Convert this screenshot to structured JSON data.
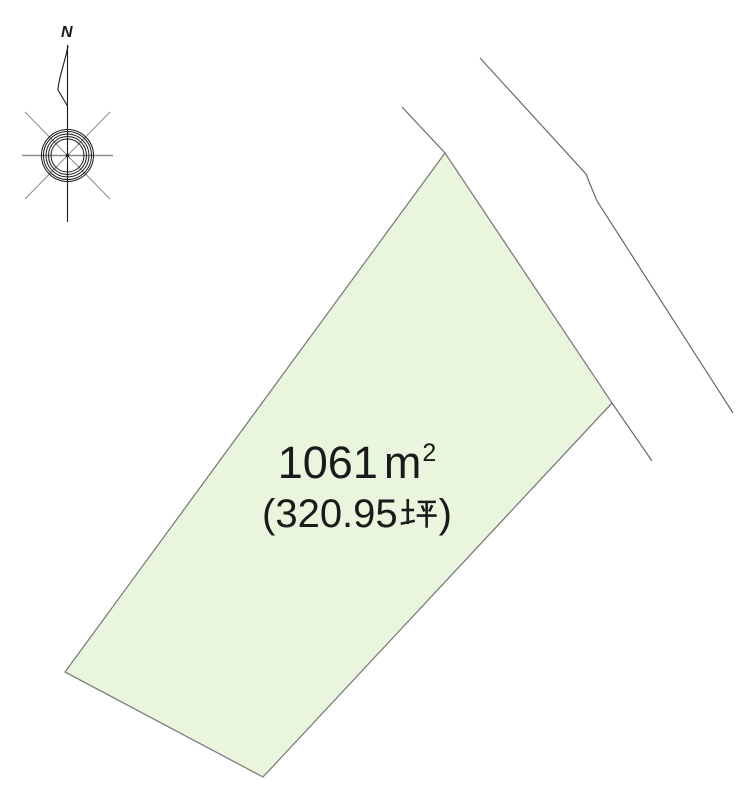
{
  "page": {
    "background_color": "#ffffff",
    "text_color": "#1a1a1a"
  },
  "compass": {
    "north_label": "N"
  },
  "parcel": {
    "area_m2": "1061㎡",
    "area_tsubo": "(320.95坪)",
    "area_m2_parts": {
      "value": "1061",
      "unit_base": "m",
      "unit_exponent": "2"
    },
    "area_tsubo_parts": {
      "open": "(320.95",
      "unit": "坪",
      "close": ")"
    },
    "fill_color": "#e9f6dd",
    "border_color": "#7e7e7e"
  },
  "roads": {
    "line_color": "#696969"
  }
}
